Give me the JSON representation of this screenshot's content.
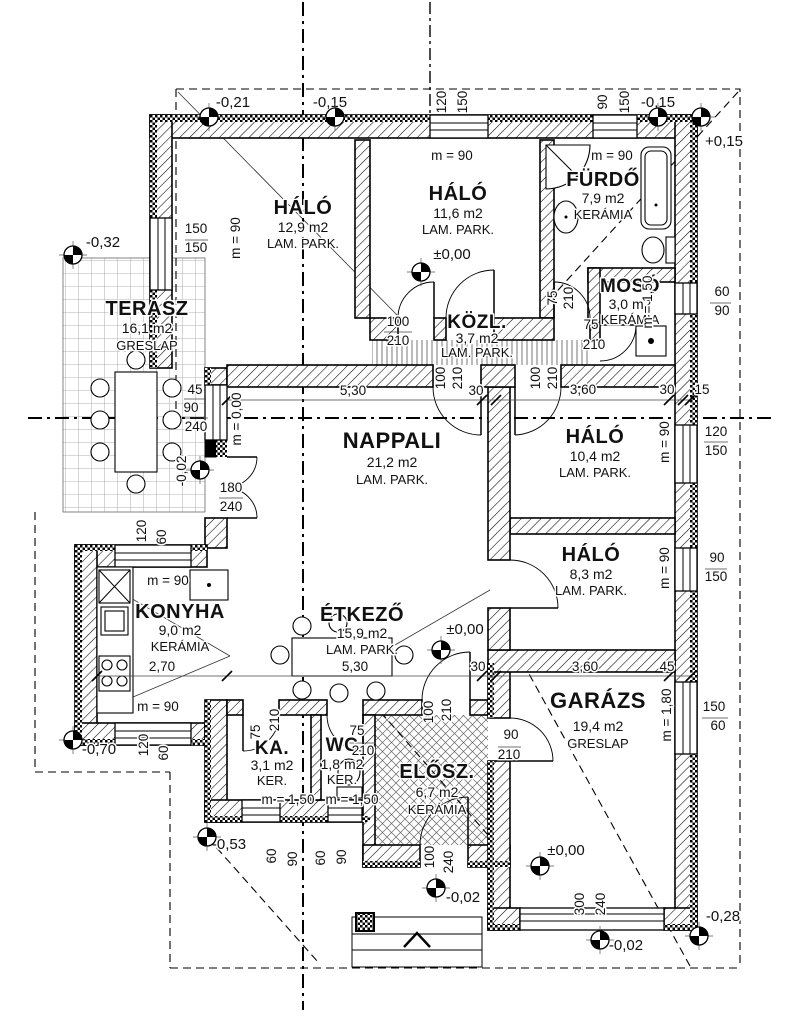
{
  "rooms": [
    {
      "name": "TERASZ",
      "area": "16,1 m2",
      "floor": "GRESLAP",
      "x": 147,
      "y": 315,
      "ya": 333,
      "yf": 350,
      "ns": 20
    },
    {
      "name": "HÁLÓ",
      "area": "12,9 m2",
      "floor": "LAM. PARK.",
      "x": 303,
      "y": 214,
      "ya": 232,
      "yf": 248,
      "ns": 20
    },
    {
      "name": "HÁLÓ",
      "area": "11,6 m2",
      "floor": "LAM. PARK.",
      "x": 458,
      "y": 200,
      "ya": 218,
      "yf": 234,
      "ns": 20
    },
    {
      "name": "FÜRDŐ",
      "area": "7,9 m2",
      "floor": "KERÁMIA",
      "x": 603,
      "y": 186,
      "ya": 203,
      "yf": 219,
      "ns": 20
    },
    {
      "name": "MOSÓ",
      "area": "3,0 m2",
      "floor": "KERÁMIA",
      "x": 630,
      "y": 292,
      "ya": 309,
      "yf": 324,
      "ns": 19
    },
    {
      "name": "KÖZL.",
      "area": "3,7 m2",
      "floor": "LAM. PARK.",
      "x": 477,
      "y": 328,
      "ya": 343,
      "yf": 357,
      "ns": 19
    },
    {
      "name": "NAPPALI",
      "area": "21,2 m2",
      "floor": "LAM. PARK.",
      "x": 392,
      "y": 448,
      "ya": 467,
      "yf": 484,
      "ns": 22
    },
    {
      "name": "HÁLÓ",
      "area": "10,4 m2",
      "floor": "LAM. PARK.",
      "x": 595,
      "y": 443,
      "ya": 461,
      "yf": 477,
      "ns": 20
    },
    {
      "name": "HÁLÓ",
      "area": "8,3 m2",
      "floor": "LAM. PARK.",
      "x": 591,
      "y": 561,
      "ya": 579,
      "yf": 595,
      "ns": 20
    },
    {
      "name": "KONYHA",
      "area": "9,0 m2",
      "floor": "KERÁMIA",
      "x": 180,
      "y": 618,
      "ya": 635,
      "yf": 651,
      "ns": 20
    },
    {
      "name": "ÉTKEZŐ",
      "area": "15,9 m2",
      "floor": "LAM. PARK.",
      "x": 362,
      "y": 621,
      "ya": 638,
      "yf": 654,
      "ns": 20
    },
    {
      "name": "GARÁZS",
      "area": "19,4 m2",
      "floor": "GRESLAP",
      "x": 598,
      "y": 708,
      "ya": 731,
      "yf": 748,
      "ns": 22
    },
    {
      "name": "KA.",
      "area": "3,1 m2",
      "floor": "KER.",
      "x": 272,
      "y": 754,
      "ya": 770,
      "yf": 785,
      "ns": 19
    },
    {
      "name": "WC",
      "area": "1,8 m2",
      "floor": "KER.",
      "x": 342,
      "y": 751,
      "ya": 769,
      "yf": 784,
      "ns": 19
    },
    {
      "name": "ELŐSZ.",
      "area": "6,7 m2",
      "floor": "KERÁMIA",
      "x": 437,
      "y": 778,
      "ya": 797,
      "yf": 814,
      "ns": 20
    }
  ],
  "annotations": [
    {
      "t": "-0,21",
      "x": 233,
      "y": 107,
      "fs": 15
    },
    {
      "t": "-0,15",
      "x": 330,
      "y": 107,
      "fs": 15
    },
    {
      "t": "120",
      "x": 446,
      "y": 102,
      "r": -90
    },
    {
      "t": "150",
      "x": 467,
      "y": 102,
      "r": -90
    },
    {
      "t": "m = 90",
      "x": 452,
      "y": 160
    },
    {
      "t": "90",
      "x": 607,
      "y": 102,
      "r": -90
    },
    {
      "t": "150",
      "x": 629,
      "y": 102,
      "r": -90
    },
    {
      "t": "-0,15",
      "x": 658,
      "y": 107,
      "fs": 15
    },
    {
      "t": "+0,15",
      "x": 724,
      "y": 146,
      "fs": 15
    },
    {
      "t": "m = 90",
      "x": 612,
      "y": 160
    },
    {
      "t": "150",
      "x": 196,
      "y": 233
    },
    {
      "t": "150",
      "x": 196,
      "y": 252
    },
    {
      "t": "m = 90",
      "x": 240,
      "y": 238,
      "r": -90
    },
    {
      "t": "-0,32",
      "x": 103,
      "y": 247,
      "fs": 15
    },
    {
      "t": "45",
      "x": 195,
      "y": 394
    },
    {
      "t": "90",
      "x": 191,
      "y": 412
    },
    {
      "t": "240",
      "x": 196,
      "y": 431
    },
    {
      "t": "m = 0,00",
      "x": 241,
      "y": 419,
      "r": -90
    },
    {
      "t": "-0,02",
      "x": 186,
      "y": 471,
      "r": -90
    },
    {
      "t": "180",
      "x": 231,
      "y": 492
    },
    {
      "t": "240",
      "x": 231,
      "y": 511
    },
    {
      "t": "120",
      "x": 146,
      "y": 531,
      "r": -90
    },
    {
      "t": "60",
      "x": 166,
      "y": 537,
      "r": -90
    },
    {
      "t": "m = 90",
      "x": 168,
      "y": 585
    },
    {
      "t": "2,70",
      "x": 162,
      "y": 671
    },
    {
      "t": "m = 90",
      "x": 158,
      "y": 711
    },
    {
      "t": "-0,70",
      "x": 99,
      "y": 754,
      "fs": 15
    },
    {
      "t": "120",
      "x": 148,
      "y": 745,
      "r": -90
    },
    {
      "t": "60",
      "x": 168,
      "y": 753,
      "r": -90
    },
    {
      "t": "5,30",
      "x": 353,
      "y": 395
    },
    {
      "t": "30",
      "x": 476,
      "y": 395
    },
    {
      "t": "3,60",
      "x": 583,
      "y": 394
    },
    {
      "t": "30",
      "x": 667,
      "y": 394
    },
    {
      "t": "15",
      "x": 702,
      "y": 394
    },
    {
      "t": "100",
      "x": 398,
      "y": 326
    },
    {
      "t": "210",
      "x": 398,
      "y": 345
    },
    {
      "t": "100",
      "x": 445,
      "y": 378,
      "r": -90
    },
    {
      "t": "210",
      "x": 462,
      "y": 378,
      "r": -90
    },
    {
      "t": "75",
      "x": 557,
      "y": 298,
      "r": -90
    },
    {
      "t": "210",
      "x": 573,
      "y": 298,
      "r": -90
    },
    {
      "t": "100",
      "x": 540,
      "y": 378,
      "r": -90
    },
    {
      "t": "210",
      "x": 557,
      "y": 378,
      "r": -90
    },
    {
      "t": "75",
      "x": 591,
      "y": 329
    },
    {
      "t": "210",
      "x": 594,
      "y": 349
    },
    {
      "t": "±0,00",
      "x": 452,
      "y": 259,
      "fs": 15
    },
    {
      "t": "60",
      "x": 722,
      "y": 296
    },
    {
      "t": "90",
      "x": 722,
      "y": 315
    },
    {
      "t": "m = 1,50",
      "x": 652,
      "y": 302,
      "r": -90
    },
    {
      "t": "m = 90",
      "x": 669,
      "y": 442,
      "r": -90
    },
    {
      "t": "120",
      "x": 716,
      "y": 436
    },
    {
      "t": "150",
      "x": 716,
      "y": 455
    },
    {
      "t": "m = 90",
      "x": 669,
      "y": 568,
      "r": -90
    },
    {
      "t": "90",
      "x": 717,
      "y": 562
    },
    {
      "t": "150",
      "x": 716,
      "y": 581
    },
    {
      "t": "m = 1,80",
      "x": 671,
      "y": 715,
      "r": -90
    },
    {
      "t": "150",
      "x": 714,
      "y": 711
    },
    {
      "t": "60",
      "x": 718,
      "y": 730
    },
    {
      "t": "5,30",
      "x": 355,
      "y": 671
    },
    {
      "t": "30",
      "x": 478,
      "y": 671
    },
    {
      "t": "3,60",
      "x": 585,
      "y": 671
    },
    {
      "t": "45",
      "x": 667,
      "y": 671
    },
    {
      "t": "±0,00",
      "x": 465,
      "y": 634,
      "fs": 15
    },
    {
      "t": "75",
      "x": 260,
      "y": 732,
      "r": -90
    },
    {
      "t": "210",
      "x": 279,
      "y": 720,
      "r": -90
    },
    {
      "t": "m = 1,50",
      "x": 288,
      "y": 804
    },
    {
      "t": "75",
      "x": 357,
      "y": 735
    },
    {
      "t": "210",
      "x": 363,
      "y": 755
    },
    {
      "t": "m = 1,50",
      "x": 352,
      "y": 804
    },
    {
      "t": "100",
      "x": 433,
      "y": 712,
      "r": -90
    },
    {
      "t": "210",
      "x": 451,
      "y": 710,
      "r": -90
    },
    {
      "t": "90",
      "x": 511,
      "y": 739
    },
    {
      "t": "210",
      "x": 509,
      "y": 759
    },
    {
      "t": "-0,53",
      "x": 229,
      "y": 849,
      "fs": 15
    },
    {
      "t": "60",
      "x": 276,
      "y": 856,
      "r": -90
    },
    {
      "t": "90",
      "x": 297,
      "y": 859,
      "r": -90
    },
    {
      "t": "60",
      "x": 325,
      "y": 858,
      "r": -90
    },
    {
      "t": "90",
      "x": 346,
      "y": 857,
      "r": -90
    },
    {
      "t": "100",
      "x": 434,
      "y": 857,
      "r": -90
    },
    {
      "t": "240",
      "x": 453,
      "y": 862,
      "r": -90
    },
    {
      "t": "±0,00",
      "x": 566,
      "y": 855,
      "fs": 15
    },
    {
      "t": "-0,02",
      "x": 463,
      "y": 902,
      "fs": 15
    },
    {
      "t": "300",
      "x": 584,
      "y": 904,
      "r": -90
    },
    {
      "t": "240",
      "x": 605,
      "y": 904,
      "r": -90
    },
    {
      "t": "-0,02",
      "x": 626,
      "y": 950,
      "fs": 15
    },
    {
      "t": "-0,28",
      "x": 723,
      "y": 921,
      "fs": 15
    }
  ],
  "level_markers": [
    {
      "x": 209,
      "y": 117
    },
    {
      "x": 335,
      "y": 117
    },
    {
      "x": 658,
      "y": 117
    },
    {
      "x": 701,
      "y": 117
    },
    {
      "x": 73,
      "y": 255
    },
    {
      "x": 421,
      "y": 272
    },
    {
      "x": 200,
      "y": 470
    },
    {
      "x": 73,
      "y": 740
    },
    {
      "x": 207,
      "y": 837
    },
    {
      "x": 441,
      "y": 650
    },
    {
      "x": 540,
      "y": 866
    },
    {
      "x": 436,
      "y": 888
    },
    {
      "x": 600,
      "y": 940
    },
    {
      "x": 699,
      "y": 936
    }
  ],
  "colors": {
    "ink": "#111111",
    "paper": "#ffffff",
    "hatch": "#000000"
  }
}
